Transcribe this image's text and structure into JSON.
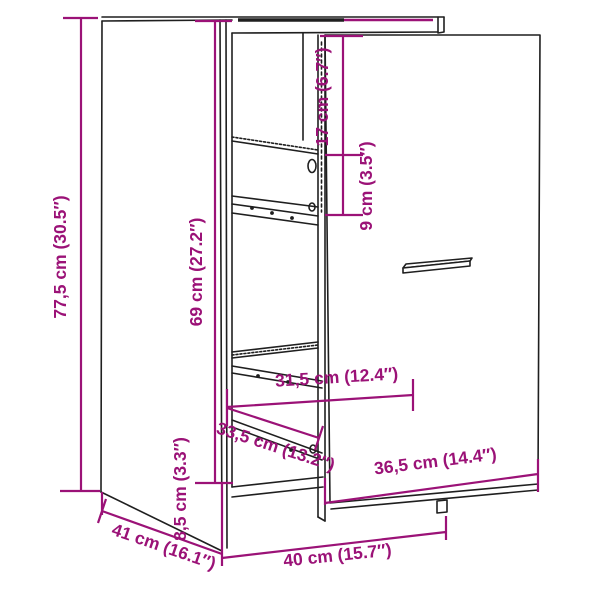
{
  "figure": {
    "kind": "furniture-dimension-diagram",
    "subject": "apothecary-cabinet-line-drawing",
    "colors": {
      "background": "#ffffff",
      "line": "#1f1f1f",
      "dimension": "#9B1277"
    },
    "dimensions": {
      "height_total": "77,5 cm (30.5″)",
      "height_interior": "69 cm (27.2″)",
      "top_section_height": "17 cm (6.7″)",
      "shelf_gap": "9 cm (3.5″)",
      "inner_width": "31,5 cm (12.4″)",
      "drawer_depth_diagonal": "33,5 cm (13.2″)",
      "front_panel_width": "36,5 cm (14.4″)",
      "plinth_height": "8,5 cm (3.3″)",
      "width_total": "40 cm (15.7″)",
      "depth_total": "41 cm (16.1″)"
    }
  }
}
